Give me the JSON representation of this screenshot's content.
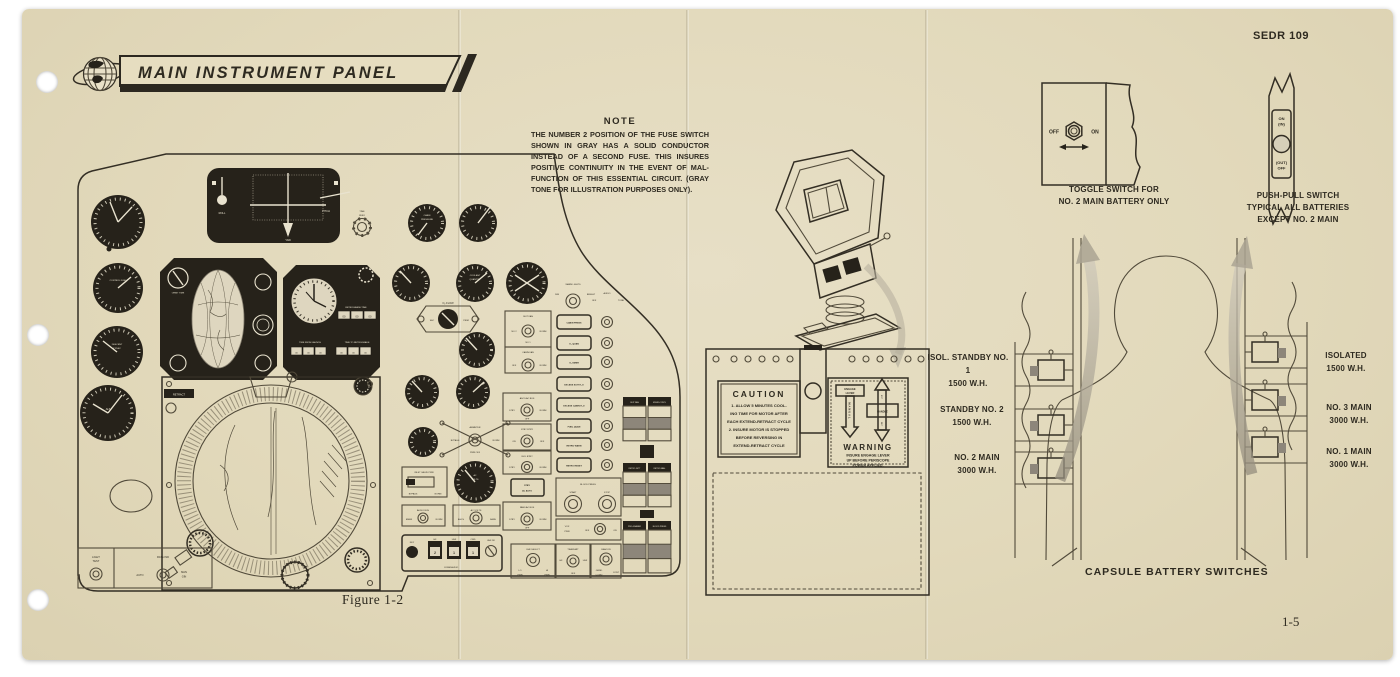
{
  "document": {
    "reference": "SEDR 109",
    "page_number": "1-5",
    "figure_caption": "Figure 1-2"
  },
  "banner": {
    "title": "MAIN INSTRUMENT PANEL"
  },
  "note": {
    "heading": "NOTE",
    "body": "THE NUMBER 2 POSITION OF THE FUSE SWITCH SHOWN IN GRAY HAS A SOLID CONDUCTOR INSTEAD OF A SECOND FUSE. THIS INSURES POSITIVE CONTINUITY IN THE EVENT OF MAL-FUNCTION OF THIS ESSENTIAL CIRCUIT. (GRAY TONE FOR ILLUSTRATION PURPOSES ONLY)."
  },
  "instrument_panel": {
    "labels": {
      "roll": "ROLL",
      "pitch": "PITCH",
      "yaw": "YAW",
      "time": "TIME",
      "zero": "ZERO",
      "control_fuel": "CONTROL FUEL",
      "descent": "DESCENT",
      "ft_sec": "FT/SEC",
      "alt": "ALT",
      "orbit_time": "ORBIT TIME",
      "retrograde_time": "RETROGRADE TIME",
      "time_from_launch": "TIME FROM LAUNCH",
      "time_to_retrograde": "TIME TO RETROGRADE",
      "zeros": "00",
      "retract": "RETRACT",
      "light": "LIGHT",
      "test": "TEST",
      "rate_ind": "RATE IND",
      "auto": "AUTO",
      "man": "MAN",
      "gin": "GIN",
      "cabin": "CABIN",
      "pressure": "PRESSURE",
      "coolant": "COOLANT",
      "quantity": "QUANTITY",
      "o2_flow": "O₂ FLOW",
      "sec": "SEC",
      "prim": "PRIM",
      "suit_fan": "SUIT FAN",
      "no_2": "NO 2",
      "no_1": "NO 1",
      "norm": "NORM",
      "off": "OFF",
      "on": "ON",
      "cabin_fan": "CABIN FAN",
      "warn_lights": "WARN LIGHTS",
      "dim": "DIM",
      "bright": "BRIGHT",
      "audio": "AUDIO",
      "tone": "TONE",
      "lt_cabin_press": "CABIN PRESS",
      "lt_o2_quan": "O₂ QUAN",
      "lt_o2_emer": "O₂ EMER",
      "lt_excess_suit": "EXCESS SUIT H₂O",
      "lt_excess_cabin": "EXCESS CABIN H₂O",
      "lt_fuel_quan": "FUEL QUAN",
      "lt_retro_warn": "RETRO WARN",
      "lt_retro_reset": "RETRO RESET",
      "ascs_ac_bus": "ASCS AC BUS",
      "stby": "STBY",
      "stby_btry": "STBY BTRY",
      "isol_btry": "ISOL BTRY",
      "ac_auto": "AC AUTO",
      "fans_ac_bus": "FANS AC BUS",
      "ammeter": "AMMETER",
      "bypass": "BYPASS",
      "pwr_off": "PWR OFF",
      "inlet_valve_pwr": "INLET VALVE PWR",
      "ac": "AC",
      "volts": "VOLTS",
      "ac_volts": "AC VOLTS",
      "ascs": "ASCS",
      "fans": "FANS",
      "audio_bus": "AUDIO BUS",
      "emer": "EMER",
      "blood_press": "BLOOD PRESS",
      "start": "START",
      "stop": "STOP",
      "vox": "VOX",
      "pwr": "PWR",
      "uhf_select": "UHF SELECT",
      "lo": "LO",
      "hi": "HI",
      "transmit": "TRANSMIT",
      "hf": "HF",
      "uhf": "UHF",
      "beacon": "BEACON",
      "grnd": "GRND",
      "comd": "COMD",
      "cont": "CONT",
      "key": "KEY",
      "cmd": "CMD",
      "comm_audio": "COMM AUDIO",
      "uhf_df": "UHF DF",
      "d_hf": "2",
      "d_uhf": "1",
      "d_cmd": "1",
      "f_suit_fan": "SUIT FAN",
      "f_envir": "ENVIR-CONTL",
      "f_retro_jett": "RETRO JETT",
      "f_retro_man": "RETRO MAN.",
      "f_programer": "PRO-GRAMER",
      "f_blood_press": "BLOOD PRESS"
    }
  },
  "fuse_panel": {
    "caution": {
      "title": "CAUTION",
      "line1": "1. ALLOW 5 MINUTES COOL-",
      "line2": "ING TIME FOR MOTOR AFTER",
      "line3": "EACH EXTEND-RETRACT CYCLE",
      "line4": "2. INSURE MOTOR IS STOPPED",
      "line5": "BEFORE REVERSING IN",
      "line6": "EXTEND-RETRACT CYCLE"
    },
    "warning": {
      "engage": "ENGAGE",
      "lever": "LEVER",
      "manual": "MANUAL",
      "handle": "HANDLE",
      "ext": "EXT",
      "ret": "RET",
      "title": "WARNING",
      "line1": "INSURE ENGAGE LEVER",
      "line2": "UP BEFORE PERISCOPE",
      "line3": "POWER APPLIED."
    }
  },
  "battery_figure": {
    "toggle_switch": {
      "off": "OFF",
      "on": "ON",
      "caption_line1": "TOGGLE SWITCH FOR",
      "caption_line2": "NO. 2 MAIN BATTERY ONLY"
    },
    "push_pull_switch": {
      "on": "ON",
      "in": "(IN)",
      "out": "(OUT)",
      "off": "OFF",
      "caption_line1": "PUSH-PULL SWITCH",
      "caption_line2": "TYPICAL ALL BATTERIES",
      "caption_line3": "EXCEPT NO. 2 MAIN"
    },
    "left_batteries": [
      {
        "name": "ISOL. STANDBY NO. 1",
        "capacity": "1500 W.H."
      },
      {
        "name": "STANDBY NO. 2",
        "capacity": "1500 W.H."
      },
      {
        "name": "NO. 2 MAIN",
        "capacity": "3000 W.H."
      }
    ],
    "right_batteries": [
      {
        "name": "ISOLATED",
        "capacity": "1500 W.H."
      },
      {
        "name": "NO. 3 MAIN",
        "capacity": "3000 W.H."
      },
      {
        "name": "NO. 1 MAIN",
        "capacity": "3000 W.H."
      }
    ],
    "caption": "CAPSULE BATTERY SWITCHES"
  },
  "colors": {
    "paper": "#e3dabc",
    "ink": "#2e2a20",
    "line": "#514a3a",
    "dark_panel": "#26221a",
    "gray_fuse": "#8d867a",
    "arrow_gray": "#b3ab9b"
  }
}
